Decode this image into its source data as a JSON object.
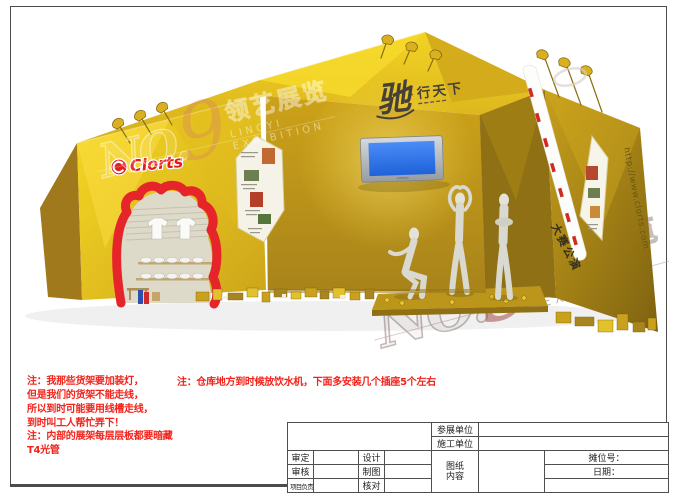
{
  "colors": {
    "gold": "#e3bd1d",
    "note_red": "#f3231b",
    "brand_red": "#e31b1f",
    "tv_screen_blue": "#2f7df5",
    "frame_gray": "#4c4c4c"
  },
  "watermark": {
    "no": "NO",
    "dot": ".",
    "nine": "9",
    "cn": "领艺展览",
    "en": "LINGYI EXHIBITION"
  },
  "booth": {
    "brand_logo": "Clorts",
    "sign_main": "驰",
    "sign_sep": "·",
    "sign_sub": "行天下",
    "right_wall_text": "大赛公演",
    "website_vertical": "http://www.clorts.com"
  },
  "notes": {
    "note1_lines": [
      "注：我那些货架要加装灯，",
      "但是我们的货架不能走线，",
      "所以到时可能要用线槽走线，",
      "到时叫工人帮忙弄下！"
    ],
    "note2_lines": [
      "注：内部的展架每层层板都要暗藏",
      "T4光管"
    ],
    "note3": "注：仓库地方到时候放饮水机，下面多安装几个插座5个左右"
  },
  "title_block": {
    "exhibitor_label": "参展单位",
    "constructor_label": "施工单位",
    "approve_label": "审定",
    "review_label": "审核",
    "lead_label": "项目负责",
    "design_label": "设计",
    "draft_label": "制图",
    "check_label": "核对",
    "content_line1": "图纸",
    "content_line2": "内容",
    "booth_no_label": "摊位号：",
    "date_label": "日期："
  }
}
